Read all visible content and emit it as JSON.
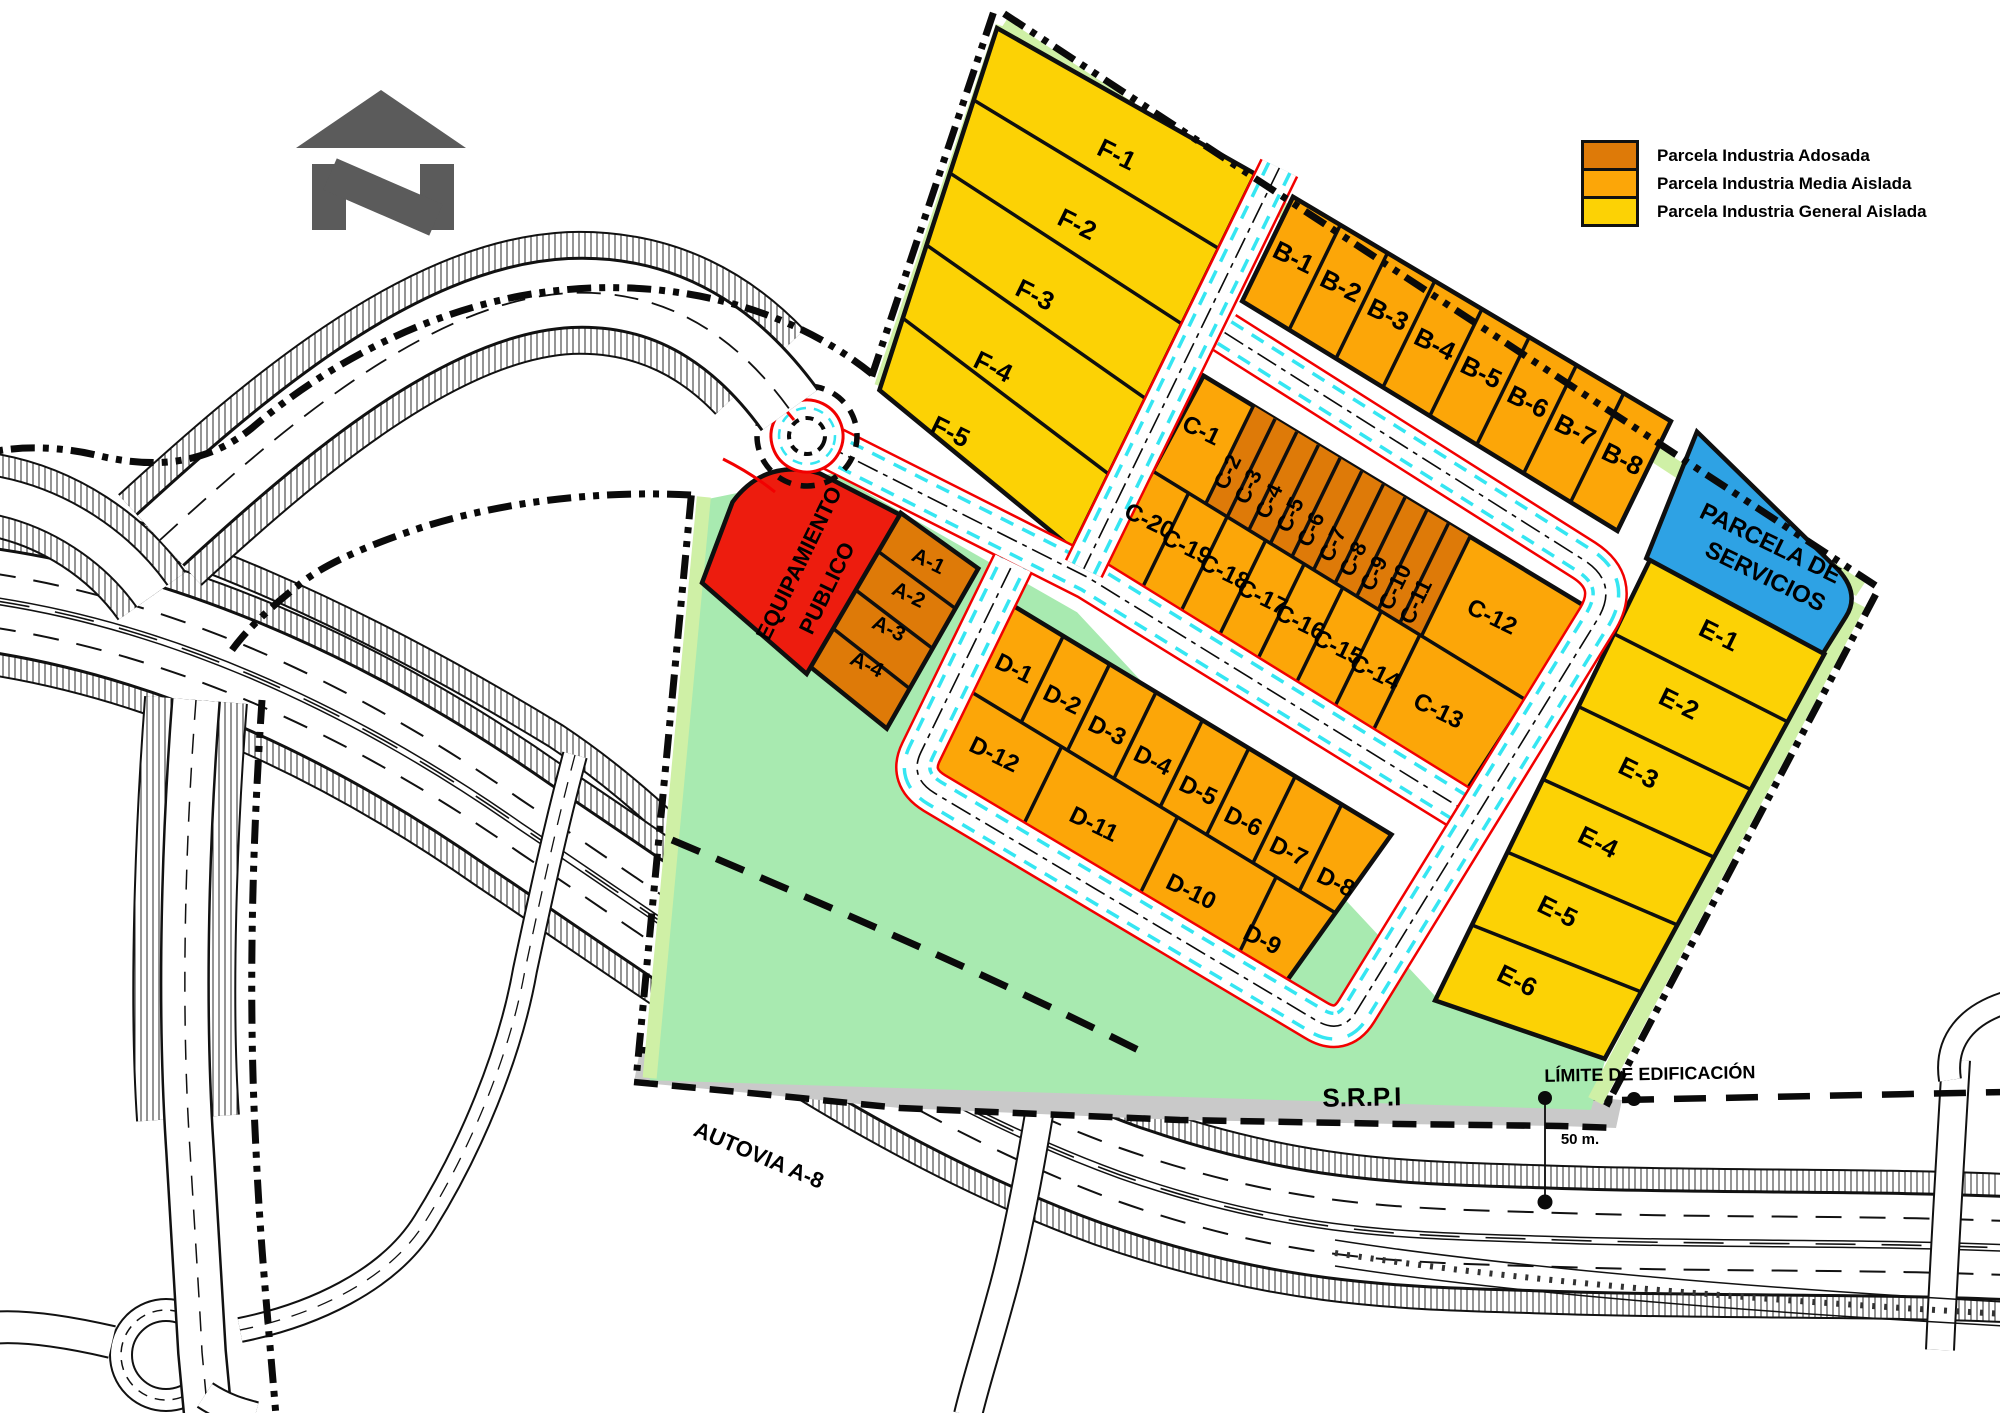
{
  "legend": {
    "items": [
      {
        "label": "Parcela Industria Adosada",
        "color": "#DE7A08"
      },
      {
        "label": "Parcela Industria Media Aislada",
        "color": "#FCA608"
      },
      {
        "label": "Parcela Industria General Aislada",
        "color": "#FCD205"
      }
    ]
  },
  "colors": {
    "adosada": "#DE7A08",
    "media": "#FCA608",
    "general": "#FCD205",
    "equipamiento": "#ED1C0E",
    "servicios": "#2EA2E4",
    "green": "#A8EAB0",
    "pale": "#CFF0A6",
    "srpi_gray": "#C9C9C9",
    "road_red": "#F20000",
    "road_cyan": "#35E6F2",
    "north_gray": "#5B5B5B"
  },
  "map_labels": [
    {
      "t": "S.R.P.I",
      "x": 1362,
      "y": 1106,
      "r": -1,
      "s": 26
    },
    {
      "t": "LÍMITE DE EDIFICACIÓN",
      "x": 1650,
      "y": 1080,
      "r": -1,
      "s": 18
    },
    {
      "t": "50 m.",
      "x": 1580,
      "y": 1144,
      "r": 0,
      "s": 15
    },
    {
      "t": "AUTOVIA  A-8",
      "x": 756,
      "y": 1162,
      "r": 23,
      "s": 22
    }
  ],
  "park_labels": [
    {
      "t": "F-1",
      "x": 155,
      "y": -380,
      "r": 0,
      "s": 26
    },
    {
      "t": "F-2",
      "x": 150,
      "y": -300,
      "r": 0,
      "s": 26
    },
    {
      "t": "F-3",
      "x": 143,
      "y": -218,
      "r": 0,
      "s": 26
    },
    {
      "t": "F-4",
      "x": 137,
      "y": -135,
      "r": 0,
      "s": 26
    },
    {
      "t": "F-5",
      "x": 127,
      "y": -58,
      "r": 0,
      "s": 26
    },
    {
      "t": "B-1",
      "x": 359,
      "y": -365,
      "r": 0,
      "s": 26
    },
    {
      "t": "B-2",
      "x": 414,
      "y": -360,
      "r": 0,
      "s": 26
    },
    {
      "t": "B-3",
      "x": 469,
      "y": -355,
      "r": 0,
      "s": 26
    },
    {
      "t": "B-4",
      "x": 524,
      "y": -349,
      "r": 0,
      "s": 26
    },
    {
      "t": "B-5",
      "x": 578,
      "y": -344,
      "r": 0,
      "s": 26
    },
    {
      "t": "B-6",
      "x": 633,
      "y": -338,
      "r": 0,
      "s": 26
    },
    {
      "t": "B-7",
      "x": 688,
      "y": -333,
      "r": 0,
      "s": 26
    },
    {
      "t": "B-8",
      "x": 743,
      "y": -328,
      "r": 0,
      "s": 26
    },
    {
      "t": "PARCELA DE",
      "x": 913,
      "y": -318,
      "r": 0,
      "s": 24
    },
    {
      "t": "SERVICIOS",
      "x": 923,
      "y": -286,
      "r": 0,
      "s": 24
    },
    {
      "t": "E-1",
      "x": 907,
      "y": -212,
      "r": 0,
      "s": 26
    },
    {
      "t": "E-2",
      "x": 901,
      "y": -133,
      "r": 0,
      "s": 26
    },
    {
      "t": "E-3",
      "x": 895,
      "y": -53,
      "r": 0,
      "s": 26
    },
    {
      "t": "E-4",
      "x": 889,
      "y": 27,
      "r": 0,
      "s": 26
    },
    {
      "t": "E-5",
      "x": 883,
      "y": 107,
      "r": 0,
      "s": 26
    },
    {
      "t": "E-6",
      "x": 877,
      "y": 187,
      "r": 0,
      "s": 26
    },
    {
      "t": "C-1",
      "x": 352,
      "y": -170,
      "r": 0,
      "s": 24
    },
    {
      "t": "C-2",
      "x": 401,
      "y": -152,
      "r": -90,
      "s": 22
    },
    {
      "t": "C-3",
      "x": 426,
      "y": -148,
      "r": -90,
      "s": 22
    },
    {
      "t": "C-4",
      "x": 451,
      "y": -144,
      "r": -90,
      "s": 22
    },
    {
      "t": "C-5",
      "x": 476,
      "y": -141,
      "r": -90,
      "s": 22
    },
    {
      "t": "C-6",
      "x": 501,
      "y": -137,
      "r": -90,
      "s": 22
    },
    {
      "t": "C-7",
      "x": 527,
      "y": -133,
      "r": -90,
      "s": 22
    },
    {
      "t": "C-8",
      "x": 552,
      "y": -129,
      "r": -90,
      "s": 22
    },
    {
      "t": "C-9",
      "x": 577,
      "y": -125,
      "r": -90,
      "s": 22
    },
    {
      "t": "C-10",
      "x": 602,
      "y": -122,
      "r": -90,
      "s": 22
    },
    {
      "t": "C-11",
      "x": 627,
      "y": -118,
      "r": -90,
      "s": 22
    },
    {
      "t": "C-12",
      "x": 695,
      "y": -130,
      "r": 0,
      "s": 24
    },
    {
      "t": "C-20",
      "x": 345,
      "y": -66,
      "r": 0,
      "s": 24
    },
    {
      "t": "C-19",
      "x": 390,
      "y": -59,
      "r": 0,
      "s": 24
    },
    {
      "t": "C-18",
      "x": 435,
      "y": -53,
      "r": 0,
      "s": 24
    },
    {
      "t": "C-17",
      "x": 480,
      "y": -47,
      "r": 0,
      "s": 24
    },
    {
      "t": "C-16",
      "x": 525,
      "y": -41,
      "r": 0,
      "s": 24
    },
    {
      "t": "C-15",
      "x": 570,
      "y": -35,
      "r": 0,
      "s": 24
    },
    {
      "t": "C-14",
      "x": 614,
      "y": -29,
      "r": 0,
      "s": 24
    },
    {
      "t": "C-13",
      "x": 688,
      "y": -22,
      "r": 0,
      "s": 24
    },
    {
      "t": "D-1",
      "x": 288,
      "y": 126,
      "r": 0,
      "s": 24
    },
    {
      "t": "D-2",
      "x": 345,
      "y": 133,
      "r": 0,
      "s": 24
    },
    {
      "t": "D-3",
      "x": 399,
      "y": 141,
      "r": 0,
      "s": 24
    },
    {
      "t": "D-4",
      "x": 453,
      "y": 148,
      "r": 0,
      "s": 24
    },
    {
      "t": "D-5",
      "x": 507,
      "y": 155,
      "r": 0,
      "s": 24
    },
    {
      "t": "D-6",
      "x": 561,
      "y": 163,
      "r": 0,
      "s": 24
    },
    {
      "t": "D-7",
      "x": 615,
      "y": 170,
      "r": 0,
      "s": 24
    },
    {
      "t": "D-8",
      "x": 671,
      "y": 177,
      "r": 0,
      "s": 24
    },
    {
      "t": "D-12",
      "x": 308,
      "y": 212,
      "r": 0,
      "s": 24
    },
    {
      "t": "D-11",
      "x": 428,
      "y": 231,
      "r": 0,
      "s": 24
    },
    {
      "t": "D-10",
      "x": 545,
      "y": 249,
      "r": 0,
      "s": 24
    },
    {
      "t": "D-9",
      "x": 630,
      "y": 261,
      "r": 0,
      "s": 24
    },
    {
      "t": "A-1",
      "x": 164,
      "y": 66,
      "r": 0,
      "s": 21
    },
    {
      "t": "A-2",
      "x": 161,
      "y": 105,
      "r": 0,
      "s": 21
    },
    {
      "t": "A-3",
      "x": 158,
      "y": 144,
      "r": 0,
      "s": 21
    },
    {
      "t": "A-4",
      "x": 154,
      "y": 186,
      "r": 0,
      "s": 21
    },
    {
      "t": "EQUIPAMIENTO",
      "x": 56,
      "y": 118,
      "r": -90,
      "s": 22
    },
    {
      "t": "PUBLICO",
      "x": 92,
      "y": 128,
      "r": -90,
      "s": 22
    }
  ]
}
